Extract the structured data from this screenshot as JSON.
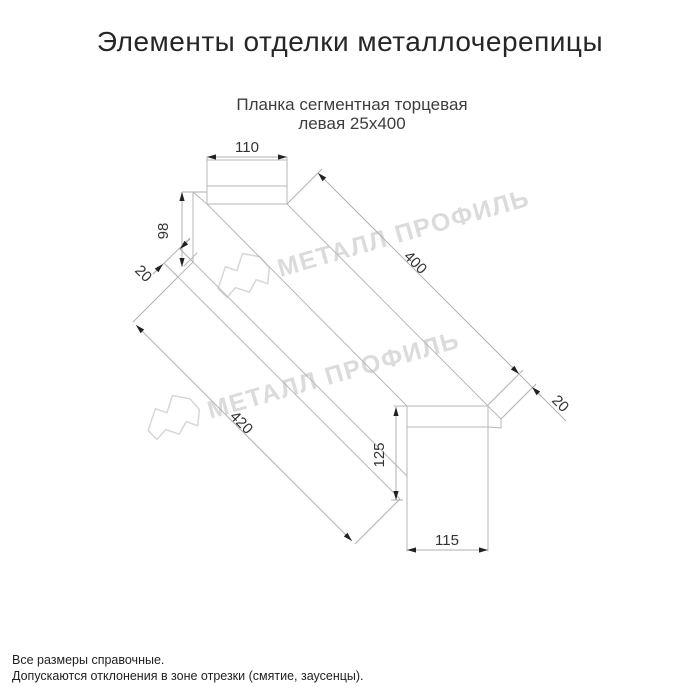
{
  "header": {
    "title": "Элементы отделки металлочерепицы"
  },
  "drawing": {
    "subtitle_line1": "Планка сегментная торцевая",
    "subtitle_line2": "левая 25х400",
    "dims": {
      "top_width": {
        "value": "110"
      },
      "left_height": {
        "value": "98"
      },
      "left_flange": {
        "value": "20"
      },
      "length_top": {
        "value": "400"
      },
      "right_flange": {
        "value": "20"
      },
      "length_bottom": {
        "value": "420"
      },
      "right_height": {
        "value": "125"
      },
      "right_width": {
        "value": "115"
      }
    },
    "colors": {
      "outline": "#b5b9b9",
      "dimension_text": "#333333",
      "arrow": "#222222",
      "watermark": "#dbdbdb"
    },
    "watermark_text": "МЕТАЛЛ ПРОФИЛЬ"
  },
  "footer": {
    "line1": "Все размеры справочные.",
    "line2": "Допускаются отклонения в зоне отрезки (смятие, заусенцы)."
  }
}
